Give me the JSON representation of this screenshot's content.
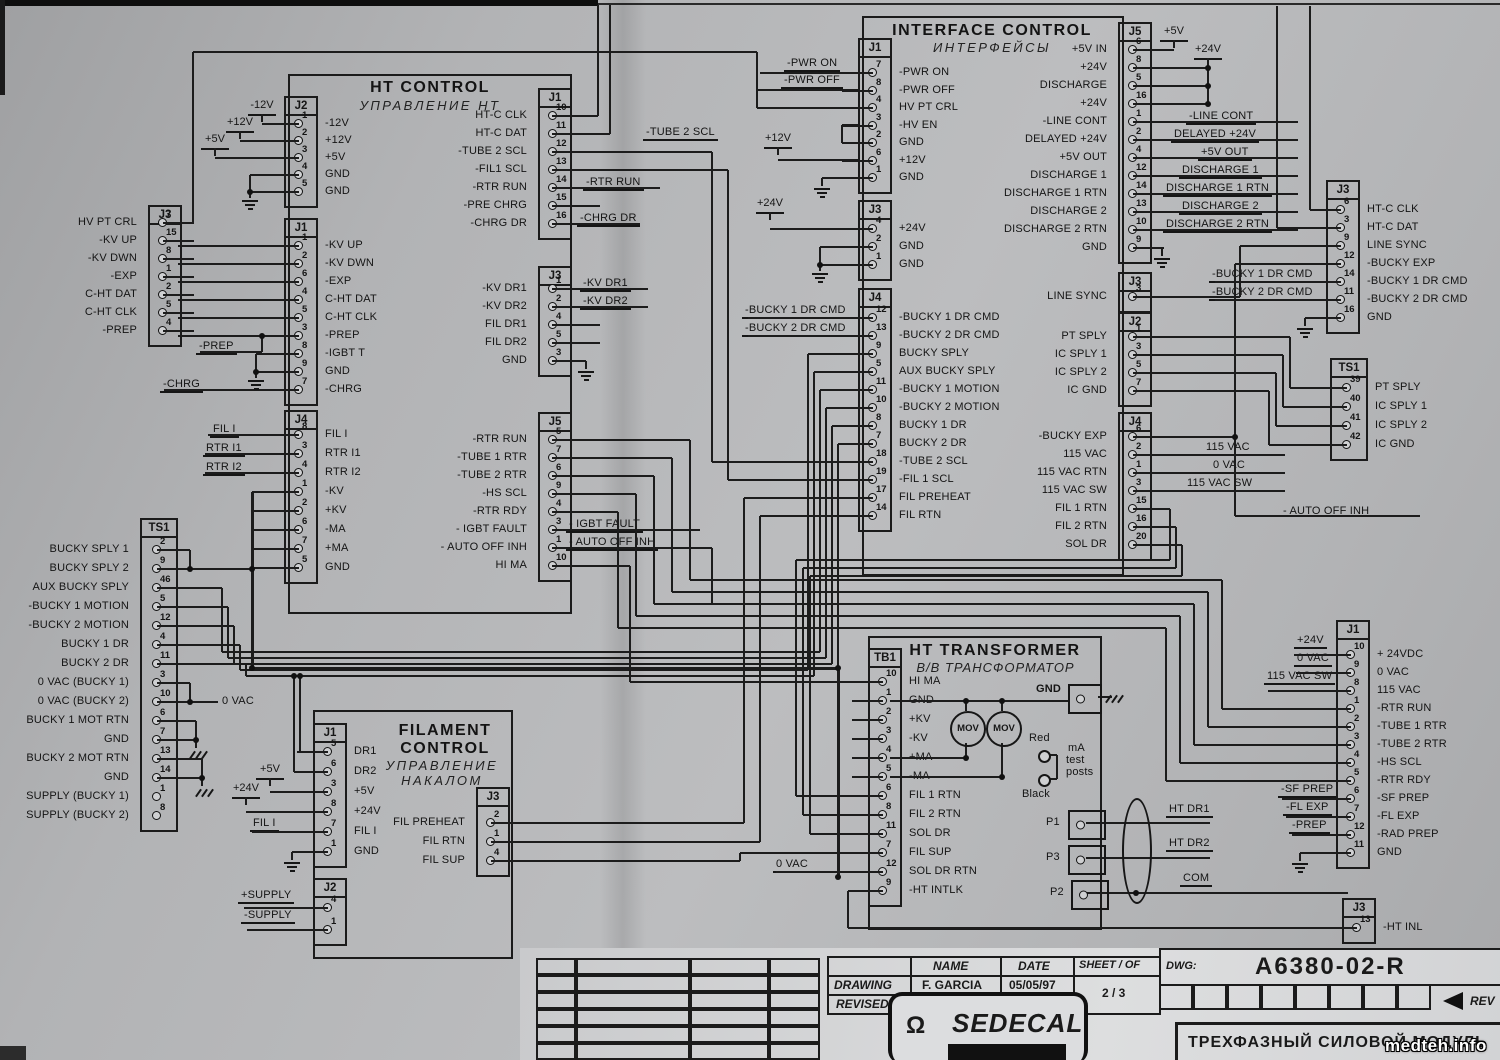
{
  "blocks": [
    {
      "title": "HT CONTROL",
      "title_ru": "УПРАВЛЕНИЕ  НТ"
    },
    {
      "title": "INTERFACE CONTROL",
      "title_ru": "ИНТЕРФЕЙСЫ"
    },
    {
      "title": "FILAMENT CONTROL",
      "title_ru": "УПРАВЛЕНИЕ НАКАЛОМ"
    },
    {
      "title": "HT TRANSFORMER",
      "title_ru": "В/В ТРАНСФОРМАТОР"
    }
  ],
  "connectors": [
    {
      "id": "htc-j2",
      "name": "J2",
      "x": 284,
      "y": 96,
      "first": 124,
      "pitch": 17,
      "w": 30,
      "wire": "left",
      "labels": "right",
      "pins": [
        [
          "1",
          "-12V"
        ],
        [
          "2",
          "+12V"
        ],
        [
          "3",
          "+5V"
        ],
        [
          "4",
          "GND"
        ],
        [
          "5",
          "GND"
        ]
      ]
    },
    {
      "id": "htc-j1-left",
      "name": "J1",
      "x": 284,
      "y": 218,
      "first": 246,
      "pitch": 18,
      "w": 30,
      "wire": "left",
      "labels": "right",
      "pins": [
        [
          "1",
          "-KV UP"
        ],
        [
          "2",
          "-KV DWN"
        ],
        [
          "6",
          "-EXP"
        ],
        [
          "4",
          "C-HT DAT"
        ],
        [
          "5",
          "C-HT CLK"
        ],
        [
          "3",
          "-PREP"
        ],
        [
          "8",
          "-IGBT T"
        ],
        [
          "9",
          "GND"
        ],
        [
          "7",
          "-CHRG"
        ]
      ]
    },
    {
      "id": "htc-j4",
      "name": "J4",
      "x": 284,
      "y": 410,
      "first": 435,
      "pitch": 19,
      "w": 30,
      "wire": "left",
      "labels": "right",
      "pins": [
        [
          "8",
          "FIL I"
        ],
        [
          "3",
          "RTR I1"
        ],
        [
          "4",
          "RTR I2"
        ],
        [
          "1",
          "-KV"
        ],
        [
          "2",
          "+KV"
        ],
        [
          "6",
          "-MA"
        ],
        [
          "7",
          "+MA"
        ],
        [
          "5",
          "GND"
        ]
      ]
    },
    {
      "id": "htc-j1-right",
      "name": "J1",
      "x": 538,
      "y": 88,
      "first": 116,
      "pitch": 18,
      "w": 30,
      "wire": "right",
      "labels": "left",
      "pins": [
        [
          "10",
          "HT-C CLK"
        ],
        [
          "11",
          "HT-C DAT"
        ],
        [
          "12",
          "-TUBE 2 SCL"
        ],
        [
          "13",
          "-FIL1 SCL"
        ],
        [
          "14",
          "-RTR RUN"
        ],
        [
          "15",
          "-PRE CHRG"
        ],
        [
          "16",
          "-CHRG DR"
        ]
      ]
    },
    {
      "id": "htc-j3-right",
      "name": "J3",
      "x": 538,
      "y": 266,
      "first": 289,
      "pitch": 18,
      "w": 30,
      "wire": "right",
      "labels": "left",
      "pins": [
        [
          "1",
          "-KV DR1"
        ],
        [
          "2",
          "-KV DR2"
        ],
        [
          "4",
          "FIL DR1"
        ],
        [
          "5",
          "FIL DR2"
        ],
        [
          "3",
          "GND"
        ]
      ]
    },
    {
      "id": "htc-j5",
      "name": "J5",
      "x": 538,
      "y": 412,
      "first": 440,
      "pitch": 18,
      "w": 30,
      "wire": "right",
      "labels": "left",
      "pins": [
        [
          "5",
          "-RTR RUN"
        ],
        [
          "7",
          "-TUBE 1 RTR"
        ],
        [
          "6",
          "-TUBE 2 RTR"
        ],
        [
          "9",
          "-HS SCL"
        ],
        [
          "4",
          "-RTR RDY"
        ],
        [
          "3",
          "- IGBT FAULT"
        ],
        [
          "1",
          "- AUTO OFF INH"
        ],
        [
          "10",
          "HI MA"
        ]
      ]
    },
    {
      "id": "left-j3",
      "name": "J3",
      "x": 148,
      "y": 205,
      "first": 223,
      "pitch": 18,
      "w": 30,
      "wire": "right",
      "labels": "left",
      "pins": [
        [
          "7",
          "HV PT CRL"
        ],
        [
          "15",
          "-KV UP"
        ],
        [
          "8",
          "-KV DWN"
        ],
        [
          "1",
          "-EXP"
        ],
        [
          "2",
          "C-HT DAT"
        ],
        [
          "5",
          "C-HT CLK"
        ],
        [
          "4",
          "-PREP"
        ]
      ]
    },
    {
      "id": "left-ts1",
      "name": "TS1",
      "x": 140,
      "y": 518,
      "first": 550,
      "pitch": 19,
      "w": 34,
      "wire": "right",
      "labels": "left",
      "skip": [
        "1",
        "8"
      ],
      "pins": [
        [
          "2",
          "BUCKY SPLY 1"
        ],
        [
          "9",
          "BUCKY SPLY 2"
        ],
        [
          "46",
          "AUX BUCKY SPLY"
        ],
        [
          "5",
          "-BUCKY 1 MOTION"
        ],
        [
          "12",
          "-BUCKY 2 MOTION"
        ],
        [
          "4",
          "BUCKY 1 DR"
        ],
        [
          "11",
          "BUCKY 2 DR"
        ],
        [
          "3",
          "0 VAC (BUCKY 1)"
        ],
        [
          "10",
          "0 VAC (BUCKY 2)"
        ],
        [
          "6",
          "BUCKY 1 MOT RTN"
        ],
        [
          "7",
          "GND"
        ],
        [
          "13",
          "BUCKY 2 MOT RTN"
        ],
        [
          "14",
          "GND"
        ],
        [
          "1",
          "SUPPLY (BUCKY 1)"
        ],
        [
          "8",
          "SUPPLY (BUCKY 2)"
        ]
      ]
    },
    {
      "id": "fil-j1",
      "name": "J1",
      "x": 313,
      "y": 723,
      "first": 752,
      "pitch": 20,
      "w": 30,
      "wire": "left",
      "labels": "right",
      "pins": [
        [
          "5",
          "DR1"
        ],
        [
          "6",
          "DR2"
        ],
        [
          "3",
          "+5V"
        ],
        [
          "8",
          "+24V"
        ],
        [
          "7",
          "FIL I"
        ],
        [
          "1",
          "GND"
        ]
      ]
    },
    {
      "id": "fil-j3",
      "name": "J3",
      "x": 476,
      "y": 787,
      "first": 823,
      "pitch": 19,
      "w": 30,
      "wire": "right",
      "labels": "left",
      "pins": [
        [
          "2",
          "FIL PREHEAT"
        ],
        [
          "1",
          "FIL RTN"
        ],
        [
          "4",
          "FIL SUP"
        ]
      ]
    },
    {
      "id": "fil-j2",
      "name": "J2",
      "x": 313,
      "y": 878,
      "first": 908,
      "pitch": 22,
      "w": 30,
      "wire": "left",
      "labels": "right",
      "pins": [
        [
          "4",
          ""
        ],
        [
          "1",
          ""
        ]
      ]
    },
    {
      "id": "int-j1",
      "name": "J1",
      "x": 858,
      "y": 38,
      "first": 73,
      "pitch": 17.5,
      "w": 30,
      "wire": "left",
      "labels": "right",
      "pins": [
        [
          "7",
          "-PWR ON"
        ],
        [
          "8",
          "-PWR OFF"
        ],
        [
          "4",
          "HV PT CRL"
        ],
        [
          "3",
          "-HV EN"
        ],
        [
          "2",
          "GND"
        ],
        [
          "6",
          "+12V"
        ],
        [
          "1",
          "GND"
        ]
      ]
    },
    {
      "id": "int-j3-left",
      "name": "J3",
      "x": 858,
      "y": 200,
      "first": 229,
      "pitch": 18,
      "w": 30,
      "wire": "left",
      "labels": "right",
      "pins": [
        [
          "4",
          "+24V"
        ],
        [
          "2",
          "GND"
        ],
        [
          "1",
          "GND"
        ]
      ]
    },
    {
      "id": "int-j4-left",
      "name": "J4",
      "x": 858,
      "y": 288,
      "first": 318,
      "pitch": 18,
      "w": 30,
      "wire": "left",
      "labels": "right",
      "pins": [
        [
          "12",
          "-BUCKY 1 DR CMD"
        ],
        [
          "13",
          "-BUCKY 2 DR CMD"
        ],
        [
          "9",
          "BUCKY SPLY"
        ],
        [
          "5",
          "AUX BUCKY SPLY"
        ],
        [
          "11",
          "-BUCKY 1 MOTION"
        ],
        [
          "10",
          "-BUCKY 2 MOTION"
        ],
        [
          "8",
          "BUCKY 1 DR"
        ],
        [
          "7",
          "BUCKY 2 DR"
        ],
        [
          "18",
          "-TUBE 2 SCL"
        ],
        [
          "19",
          "-FIL 1 SCL"
        ],
        [
          "17",
          "FIL PREHEAT"
        ],
        [
          "14",
          "FIL RTN"
        ]
      ]
    },
    {
      "id": "int-j5",
      "name": "J5",
      "x": 1118,
      "y": 22,
      "first": 50,
      "pitch": 18,
      "w": 30,
      "wire": "right",
      "labels": "left",
      "pins": [
        [
          "6",
          "+5V IN"
        ],
        [
          "8",
          "+24V"
        ],
        [
          "5",
          "DISCHARGE"
        ],
        [
          "16",
          "+24V"
        ],
        [
          "1",
          "-LINE CONT"
        ],
        [
          "2",
          "DELAYED +24V"
        ],
        [
          "4",
          "+5V OUT"
        ],
        [
          "12",
          "DISCHARGE 1"
        ],
        [
          "14",
          "DISCHARGE 1 RTN"
        ],
        [
          "13",
          "DISCHARGE 2"
        ],
        [
          "10",
          "DISCHARGE 2 RTN"
        ],
        [
          "9",
          "GND"
        ]
      ]
    },
    {
      "id": "int-j3-right",
      "name": "J3",
      "x": 1118,
      "y": 272,
      "first": 297,
      "pitch": 18,
      "w": 30,
      "wire": "right",
      "labels": "left",
      "pins": [
        [
          "3",
          "LINE SYNC"
        ]
      ]
    },
    {
      "id": "int-j2-right",
      "name": "J2",
      "x": 1118,
      "y": 312,
      "first": 337,
      "pitch": 18,
      "w": 30,
      "wire": "right",
      "labels": "left",
      "pins": [
        [
          "1",
          "PT SPLY"
        ],
        [
          "3",
          "IC SPLY 1"
        ],
        [
          "5",
          "IC SPLY 2"
        ],
        [
          "7",
          "IC GND"
        ]
      ]
    },
    {
      "id": "int-j4-right",
      "name": "J4",
      "x": 1118,
      "y": 412,
      "first": 437,
      "pitch": 18,
      "w": 30,
      "wire": "right",
      "labels": "left",
      "pins": [
        [
          "6",
          "-BUCKY EXP"
        ],
        [
          "2",
          "115 VAC"
        ],
        [
          "1",
          "115 VAC RTN"
        ],
        [
          "3",
          "115 VAC SW"
        ],
        [
          "15",
          "FIL 1 RTN"
        ],
        [
          "16",
          "FIL 2 RTN"
        ],
        [
          "20",
          "SOL DR"
        ]
      ]
    },
    {
      "id": "right-j3",
      "name": "J3",
      "x": 1326,
      "y": 180,
      "first": 210,
      "pitch": 18,
      "w": 30,
      "wire": "left",
      "labels": "right",
      "pins": [
        [
          "6",
          "HT-C CLK"
        ],
        [
          "3",
          "HT-C DAT"
        ],
        [
          "9",
          "LINE SYNC"
        ],
        [
          "12",
          "-BUCKY EXP"
        ],
        [
          "14",
          "-BUCKY 1 DR CMD"
        ],
        [
          "11",
          "-BUCKY 2 DR CMD"
        ],
        [
          "16",
          "GND"
        ]
      ]
    },
    {
      "id": "right-ts1",
      "name": "TS1",
      "x": 1330,
      "y": 358,
      "first": 388,
      "pitch": 19,
      "w": 34,
      "wire": "left",
      "labels": "right",
      "pins": [
        [
          "39",
          "PT SPLY"
        ],
        [
          "40",
          "IC SPLY 1"
        ],
        [
          "41",
          "IC SPLY 2"
        ],
        [
          "42",
          "IC GND"
        ]
      ]
    },
    {
      "id": "right-j1",
      "name": "J1",
      "x": 1336,
      "y": 620,
      "first": 655,
      "pitch": 18,
      "w": 30,
      "wire": "left",
      "labels": "right",
      "pins": [
        [
          "10",
          "+ 24VDC"
        ],
        [
          "9",
          "0 VAC"
        ],
        [
          "8",
          "115 VAC"
        ],
        [
          "1",
          "-RTR RUN"
        ],
        [
          "2",
          "-TUBE 1 RTR"
        ],
        [
          "3",
          "-TUBE 2 RTR"
        ],
        [
          "4",
          "-HS SCL"
        ],
        [
          "5",
          "-RTR RDY"
        ],
        [
          "6",
          "-SF PREP"
        ],
        [
          "7",
          "-FL EXP"
        ],
        [
          "12",
          "-RAD PREP"
        ],
        [
          "11",
          "GND"
        ]
      ]
    },
    {
      "id": "right-j3-bottom",
      "name": "J3",
      "x": 1342,
      "y": 898,
      "first": 928,
      "pitch": 18,
      "w": 30,
      "wire": "left",
      "labels": "right",
      "pins": [
        [
          "13",
          "-HT INL"
        ]
      ]
    },
    {
      "id": "tb1",
      "name": "TB1",
      "x": 868,
      "y": 648,
      "first": 682,
      "pitch": 19,
      "w": 30,
      "wire": "left",
      "labels": "right",
      "pins": [
        [
          "10",
          "HI MA"
        ],
        [
          "1",
          "GND"
        ],
        [
          "2",
          "+KV"
        ],
        [
          "3",
          "-KV"
        ],
        [
          "4",
          "+MA"
        ],
        [
          "5",
          "-MA"
        ],
        [
          "6",
          "FIL 1 RTN"
        ],
        [
          "8",
          "FIL 2 RTN"
        ],
        [
          "11",
          "SOL DR"
        ],
        [
          "7",
          "FIL SUP"
        ],
        [
          "12",
          "SOL DR RTN"
        ],
        [
          "9",
          "-HT INTLK"
        ]
      ]
    }
  ],
  "ext_labels": [
    {
      "t": "-TUBE 2 SCL",
      "x": 643,
      "y": 126,
      "u": 1
    },
    {
      "t": "-RTR RUN",
      "x": 583,
      "y": 176,
      "u": 1
    },
    {
      "t": "-CHRG DR",
      "x": 577,
      "y": 212,
      "u": 1
    },
    {
      "t": "-KV DR1",
      "x": 580,
      "y": 277,
      "u": 1
    },
    {
      "t": "-KV DR2",
      "x": 580,
      "y": 295,
      "u": 1
    },
    {
      "t": "- IGBT FAULT",
      "x": 566,
      "y": 518,
      "u": 1
    },
    {
      "t": "- AUTO OFF INH",
      "x": 566,
      "y": 536,
      "u": 1
    },
    {
      "t": "-PREP",
      "x": 196,
      "y": 340,
      "u": 1
    },
    {
      "t": "-CHRG",
      "x": 160,
      "y": 378,
      "u": 1
    },
    {
      "t": "FIL I",
      "x": 210,
      "y": 423,
      "u": 1
    },
    {
      "t": "RTR I1",
      "x": 203,
      "y": 442,
      "u": 1
    },
    {
      "t": "RTR I2",
      "x": 203,
      "y": 461,
      "u": 1
    },
    {
      "t": "0 VAC",
      "x": 222,
      "y": 695,
      "u": 0
    },
    {
      "t": "-PWR ON",
      "x": 784,
      "y": 57,
      "u": 1
    },
    {
      "t": "-PWR OFF",
      "x": 781,
      "y": 74,
      "u": 1
    },
    {
      "t": "-BUCKY 1 DR CMD",
      "x": 742,
      "y": 304,
      "u": 1
    },
    {
      "t": "-BUCKY 2 DR CMD",
      "x": 742,
      "y": 322,
      "u": 1
    },
    {
      "t": "-LINE CONT",
      "x": 1186,
      "y": 110,
      "u": 1
    },
    {
      "t": "DELAYED +24V",
      "x": 1171,
      "y": 128,
      "u": 1
    },
    {
      "t": "+5V OUT",
      "x": 1198,
      "y": 146,
      "u": 1
    },
    {
      "t": "DISCHARGE 1",
      "x": 1179,
      "y": 164,
      "u": 1
    },
    {
      "t": "DISCHARGE 1 RTN",
      "x": 1163,
      "y": 182,
      "u": 1
    },
    {
      "t": "DISCHARGE 2",
      "x": 1179,
      "y": 200,
      "u": 1
    },
    {
      "t": "DISCHARGE 2 RTN",
      "x": 1163,
      "y": 218,
      "u": 1
    },
    {
      "t": "-BUCKY 1 DR CMD",
      "x": 1209,
      "y": 268,
      "u": 1
    },
    {
      "t": "-BUCKY 2 DR CMD",
      "x": 1209,
      "y": 286,
      "u": 1
    },
    {
      "t": "115 VAC",
      "x": 1203,
      "y": 441,
      "u": 1
    },
    {
      "t": "0 VAC",
      "x": 1210,
      "y": 459,
      "u": 1
    },
    {
      "t": "115 VAC SW",
      "x": 1184,
      "y": 477,
      "u": 1
    },
    {
      "t": "- AUTO OFF INH",
      "x": 1283,
      "y": 505,
      "u": 0
    },
    {
      "t": "+24V",
      "x": 1294,
      "y": 634,
      "u": 1
    },
    {
      "t": "0 VAC",
      "x": 1294,
      "y": 652,
      "u": 1
    },
    {
      "t": "115 VAC SW",
      "x": 1264,
      "y": 670,
      "u": 1
    },
    {
      "t": "-SF PREP",
      "x": 1278,
      "y": 783,
      "u": 1
    },
    {
      "t": "-FL EXP",
      "x": 1283,
      "y": 801,
      "u": 1
    },
    {
      "t": "-PREP",
      "x": 1289,
      "y": 819,
      "u": 1
    },
    {
      "t": "0 VAC",
      "x": 773,
      "y": 858,
      "u": 1
    },
    {
      "t": "HT DR1",
      "x": 1166,
      "y": 803,
      "u": 1
    },
    {
      "t": "HT DR2",
      "x": 1166,
      "y": 837,
      "u": 1
    },
    {
      "t": "COM",
      "x": 1180,
      "y": 872,
      "u": 1
    },
    {
      "t": "FIL I",
      "x": 250,
      "y": 817,
      "u": 1
    },
    {
      "t": "+SUPPLY",
      "x": 238,
      "y": 889,
      "u": 1
    },
    {
      "t": "-SUPPLY",
      "x": 241,
      "y": 909,
      "u": 1
    }
  ],
  "rails": [
    {
      "t": "-12V",
      "x": 262,
      "y": 114
    },
    {
      "t": "+12V",
      "x": 240,
      "y": 131
    },
    {
      "t": "+5V",
      "x": 215,
      "y": 148
    },
    {
      "t": "+12V",
      "x": 778,
      "y": 147
    },
    {
      "t": "+24V",
      "x": 770,
      "y": 212
    },
    {
      "t": "+5V",
      "x": 1174,
      "y": 40
    },
    {
      "t": "+24V",
      "x": 1208,
      "y": 58
    },
    {
      "t": "+5V",
      "x": 270,
      "y": 778
    },
    {
      "t": "+24V",
      "x": 246,
      "y": 797
    }
  ],
  "transformer": {
    "mov": "MOV",
    "gnd_terminal": "GND",
    "red": "Red",
    "black": "Black",
    "ma_test_1": "mA",
    "ma_test_2": "test",
    "ma_test_3": "posts",
    "p1": "P1",
    "p3": "P3",
    "p2": "P2"
  },
  "title_block": {
    "name_header": "NAME",
    "date_header": "DATE",
    "sheet_header": "SHEET / OF",
    "drawing_label": "DRAWING",
    "drawing_name": "F. GARCIA",
    "drawing_date": "05/05/97",
    "revised_label": "REVISED",
    "revised_name": "A. DIAZ",
    "revised_date": "05/05/97",
    "sheet_value": "2 / 3",
    "dwg_label": "DWG:",
    "dwg_number": "A6380-02-R",
    "rev_label": "REV",
    "company": "SEDECAL",
    "omega": "Ω",
    "doc_title": "ТРЕХФАЗНЫЙ  СИЛОВОЙ  МОДУЛЬ",
    "watermark": "medteh.info"
  }
}
